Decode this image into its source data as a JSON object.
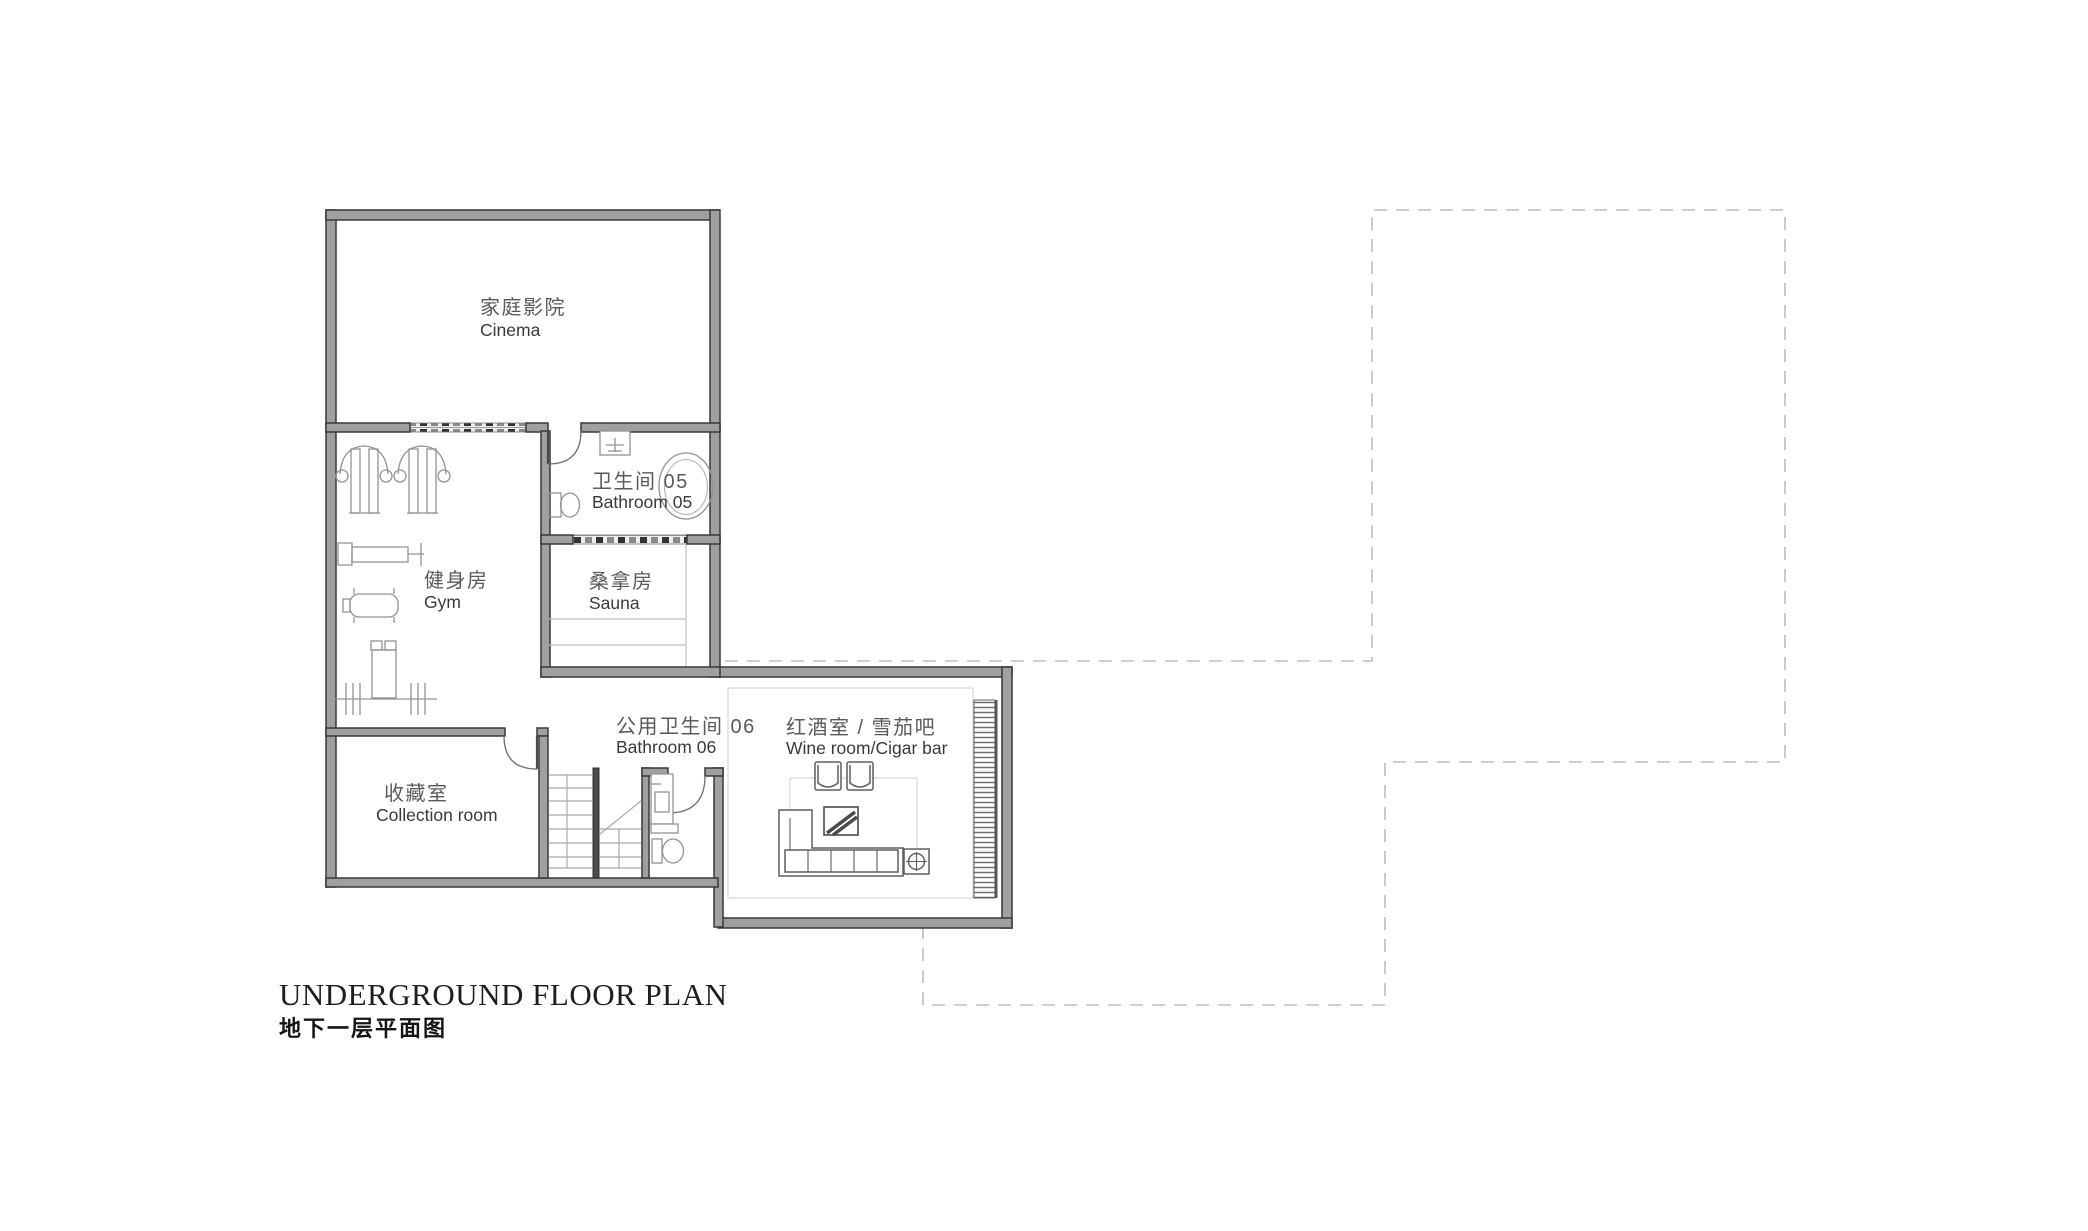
{
  "title": {
    "line1": "UNDERGROUND FLOOR PLAN",
    "line2": "地下一层平面图"
  },
  "rooms": {
    "cinema": {
      "cjk": "家庭影院",
      "en": "Cinema"
    },
    "bathroom05": {
      "cjk": "卫生间 05",
      "en": "Bathroom 05"
    },
    "gym": {
      "cjk": "健身房",
      "en": "Gym"
    },
    "sauna": {
      "cjk": "桑拿房",
      "en": "Sauna"
    },
    "bathroom06": {
      "cjk": "公用卫生间 06",
      "en": "Bathroom 06"
    },
    "wine_room": {
      "cjk": "红酒室 / 雪茄吧",
      "en": "Wine room/Cigar bar"
    },
    "collection": {
      "cjk": "收藏室",
      "en": "Collection room"
    }
  },
  "colors": {
    "wall_fill": "#a0a0a0",
    "wall_edge": "#383838",
    "furniture_line": "#939393",
    "dashed_outline": "#bdbdbd",
    "label_cjk": "#5a5a5a",
    "label_en": "#3a3a3a",
    "title": "#1e1e1e",
    "background": "#ffffff"
  }
}
